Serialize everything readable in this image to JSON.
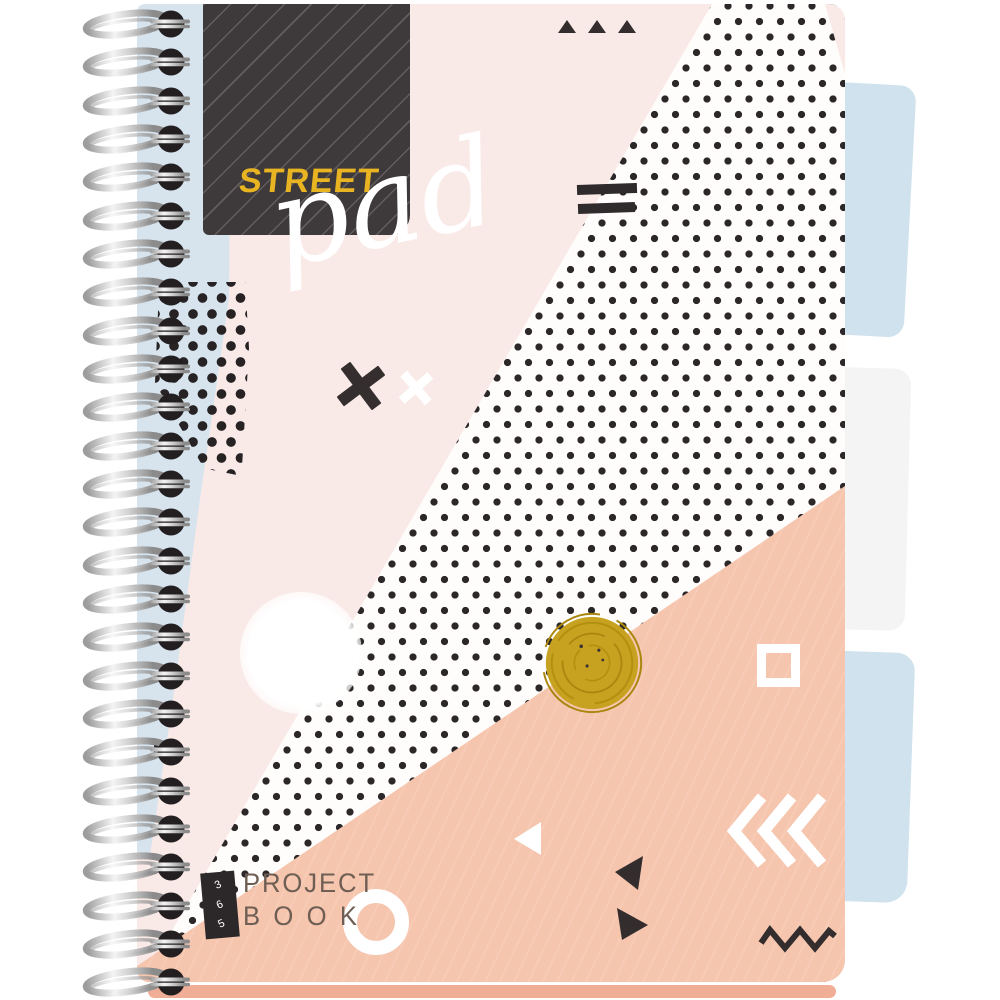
{
  "product": {
    "brand": "STREET",
    "line_script": "pad",
    "series": {
      "digits": [
        "3",
        "6",
        "5"
      ]
    },
    "title": {
      "line1": "PROJECT",
      "line2": "BOOK"
    }
  },
  "palette": {
    "cover_pink": "#faeae7",
    "salmon": "#f6c5ae",
    "light_blue": "#d7e4ee",
    "tab_blue": "#cfe2ed",
    "tab_white": "#f3f4f3",
    "dark_square": "#3e393a",
    "brand_yellow": "#e8b421",
    "ink_black": "#2c2728",
    "gold_circle": "#c7a120",
    "text_brown": "#6f5e53",
    "pages_edge": "#f1ae97"
  }
}
